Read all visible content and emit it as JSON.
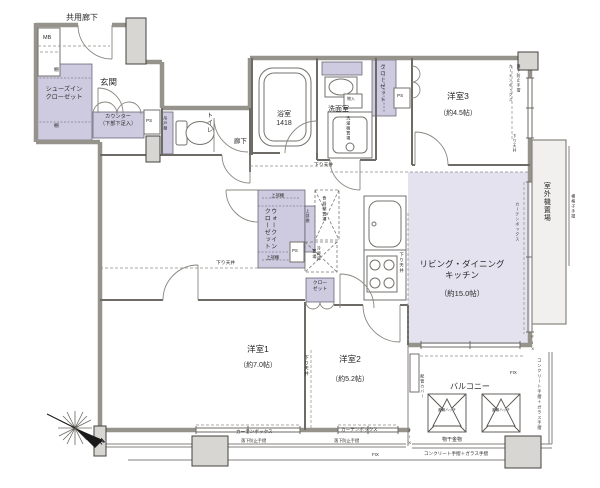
{
  "labels": {
    "common_corridor": "共用廊下",
    "mb": "MB",
    "entrance": "玄関",
    "shoes_in_closet": "シューズイン\nクローゼット",
    "shelf": "棚",
    "counter": "カウンター\n（下部下足入）",
    "ps": "PS",
    "toilet": "トイレ",
    "hanging_shelf": "吊戸棚",
    "hallway": "廊下",
    "bathroom": "浴室\n1418",
    "washroom": "洗面室",
    "small_storage": "物入",
    "washer_space": "洗濯機置場",
    "closet": "クローゼット",
    "closet_small": "クロー\nゼット",
    "walk_in_closet": "ウォークイン\nクローゼット",
    "upper_shelf": "上部棚",
    "dish_cabinet_space": "食器棚置場",
    "fridge_space": "冷蔵庫\n置場",
    "dropped_ceiling": "下り天井",
    "curtain_box": "カーテンボックス",
    "fall_prevention_rail": "落下防止手摺",
    "outdoor_unit_space": "室外機置場",
    "lattice_rail": "横格子手摺",
    "fix": "FIX",
    "balcony": "バルコニー",
    "pipe_cover": "配管カバー",
    "evacuation_hatch": "避難ハッチ",
    "drying_fixture": "物干金物",
    "concrete_glass_rail": "コンクリート手摺＋ガラス手摺",
    "north": "N"
  },
  "rooms": {
    "bedroom3": {
      "name": "洋室3",
      "size": "（約4.5帖）"
    },
    "ldk": {
      "name": "リビング・ダイニング\nキッチン",
      "size": "（約15.0帖）"
    },
    "bedroom1": {
      "name": "洋室1",
      "size": "（約7.0帖）"
    },
    "bedroom2": {
      "name": "洋室2",
      "size": "（約5.2帖）"
    }
  },
  "colors": {
    "wall": "#96938d",
    "closet_fill": "#cecbe0",
    "ldk_fill": "#e4e2ef",
    "pillar_fill": "#d8d6d2"
  }
}
